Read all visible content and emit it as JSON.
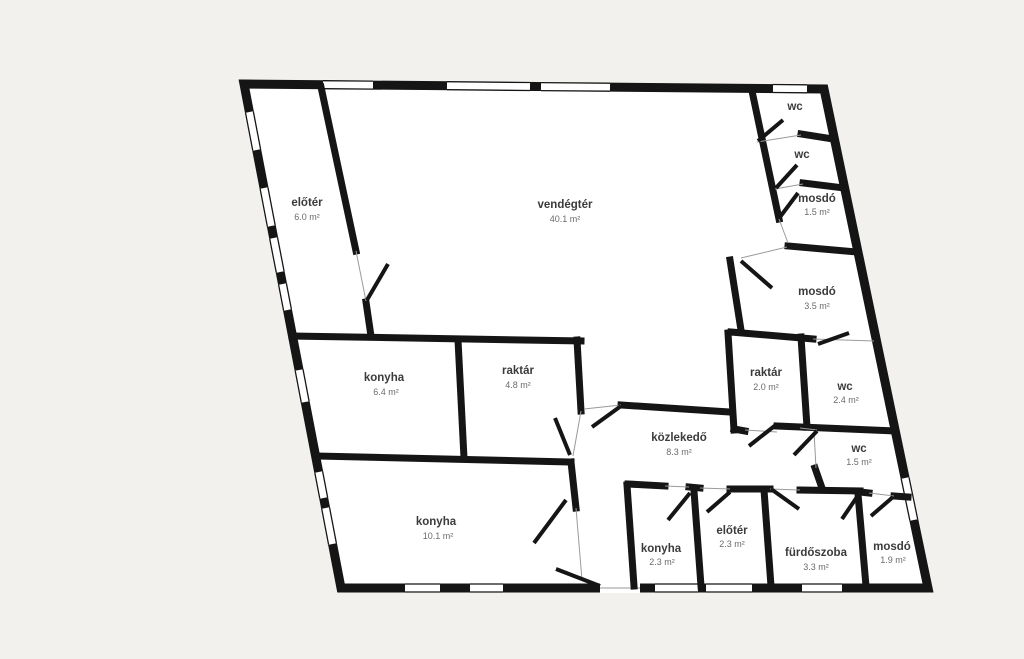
{
  "plan": {
    "type": "floor-plan",
    "colors": {
      "background": "#f2f1ee",
      "floor": "#ffffff",
      "wall": "#151515",
      "label": "#3b3b3b",
      "area_label": "#6b6b6b"
    },
    "rooms": [
      {
        "name": "előtér",
        "area": "6.0 m²"
      },
      {
        "name": "vendégtér",
        "area": "40.1 m²"
      },
      {
        "name": "wc",
        "area": ""
      },
      {
        "name": "wc",
        "area": ""
      },
      {
        "name": "mosdó",
        "area": "1.5 m²"
      },
      {
        "name": "mosdó",
        "area": "3.5 m²"
      },
      {
        "name": "konyha",
        "area": "6.4 m²"
      },
      {
        "name": "raktár",
        "area": "4.8 m²"
      },
      {
        "name": "raktár",
        "area": "2.0 m²"
      },
      {
        "name": "wc",
        "area": "2.4 m²"
      },
      {
        "name": "közlekedő",
        "area": "8.3 m²"
      },
      {
        "name": "wc",
        "area": "1.5 m²"
      },
      {
        "name": "konyha",
        "area": "10.1 m²"
      },
      {
        "name": "konyha",
        "area": "2.3 m²"
      },
      {
        "name": "előtér",
        "area": "2.3 m²"
      },
      {
        "name": "fürdőszoba",
        "area": "3.3 m²"
      },
      {
        "name": "mosdó",
        "area": "1.9 m²"
      }
    ]
  }
}
